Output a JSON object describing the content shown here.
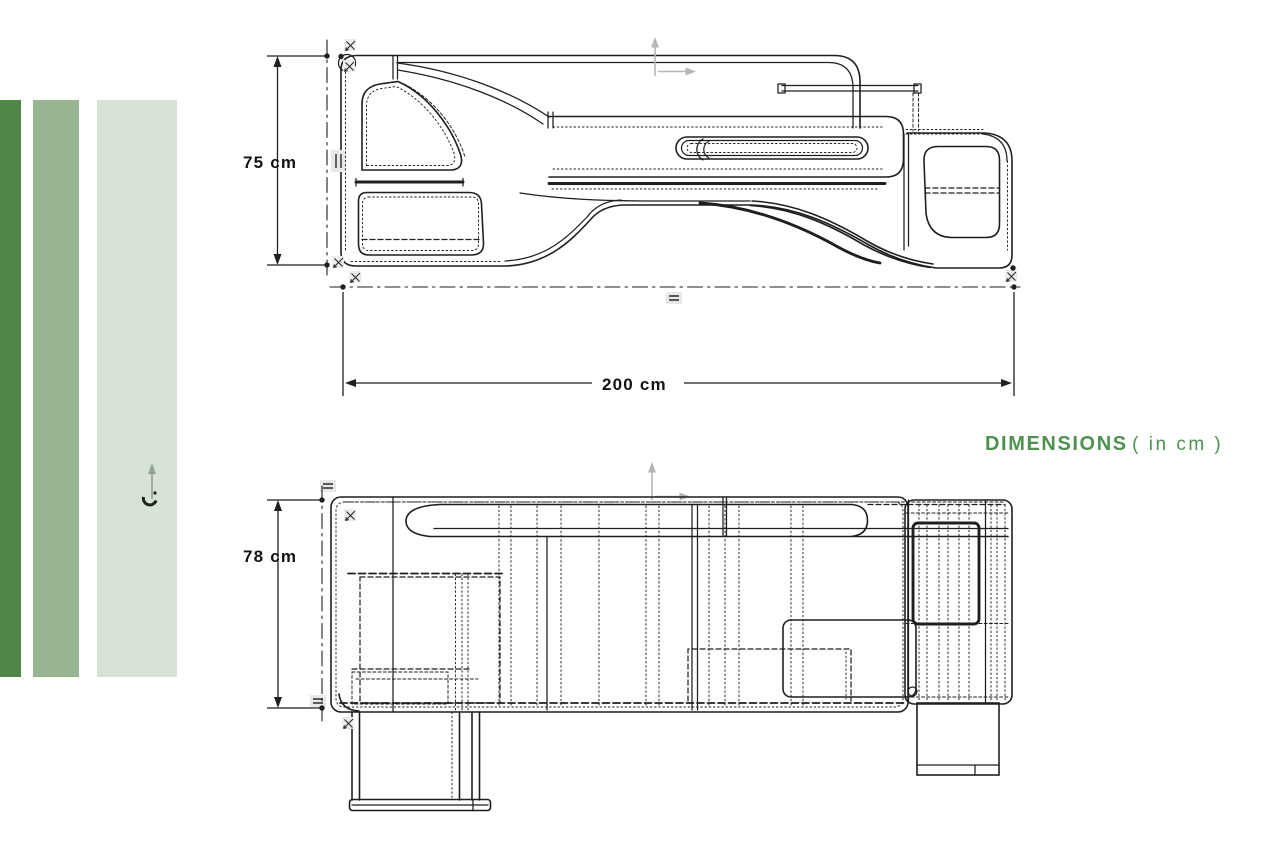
{
  "canvas": {
    "width": 1280,
    "height": 850,
    "background": "#ffffff"
  },
  "stripes": {
    "items": [
      {
        "name": "dark-green",
        "color": "#4f8749"
      },
      {
        "name": "medium-green",
        "color": "#97b690"
      },
      {
        "name": "light-green",
        "color": "#d6e2d3"
      }
    ]
  },
  "title": {
    "label": "DIMENSIONS",
    "suffix": "( in cm )",
    "color": "#4e9150"
  },
  "views": {
    "side": {
      "height_label": "75 cm",
      "width_label": "200 cm"
    },
    "plan": {
      "height_label": "78 cm"
    }
  },
  "drawing": {
    "stroke": "#1f1f1f",
    "axis_color": "#b5b5b5",
    "marker_fill": "#ececec"
  }
}
